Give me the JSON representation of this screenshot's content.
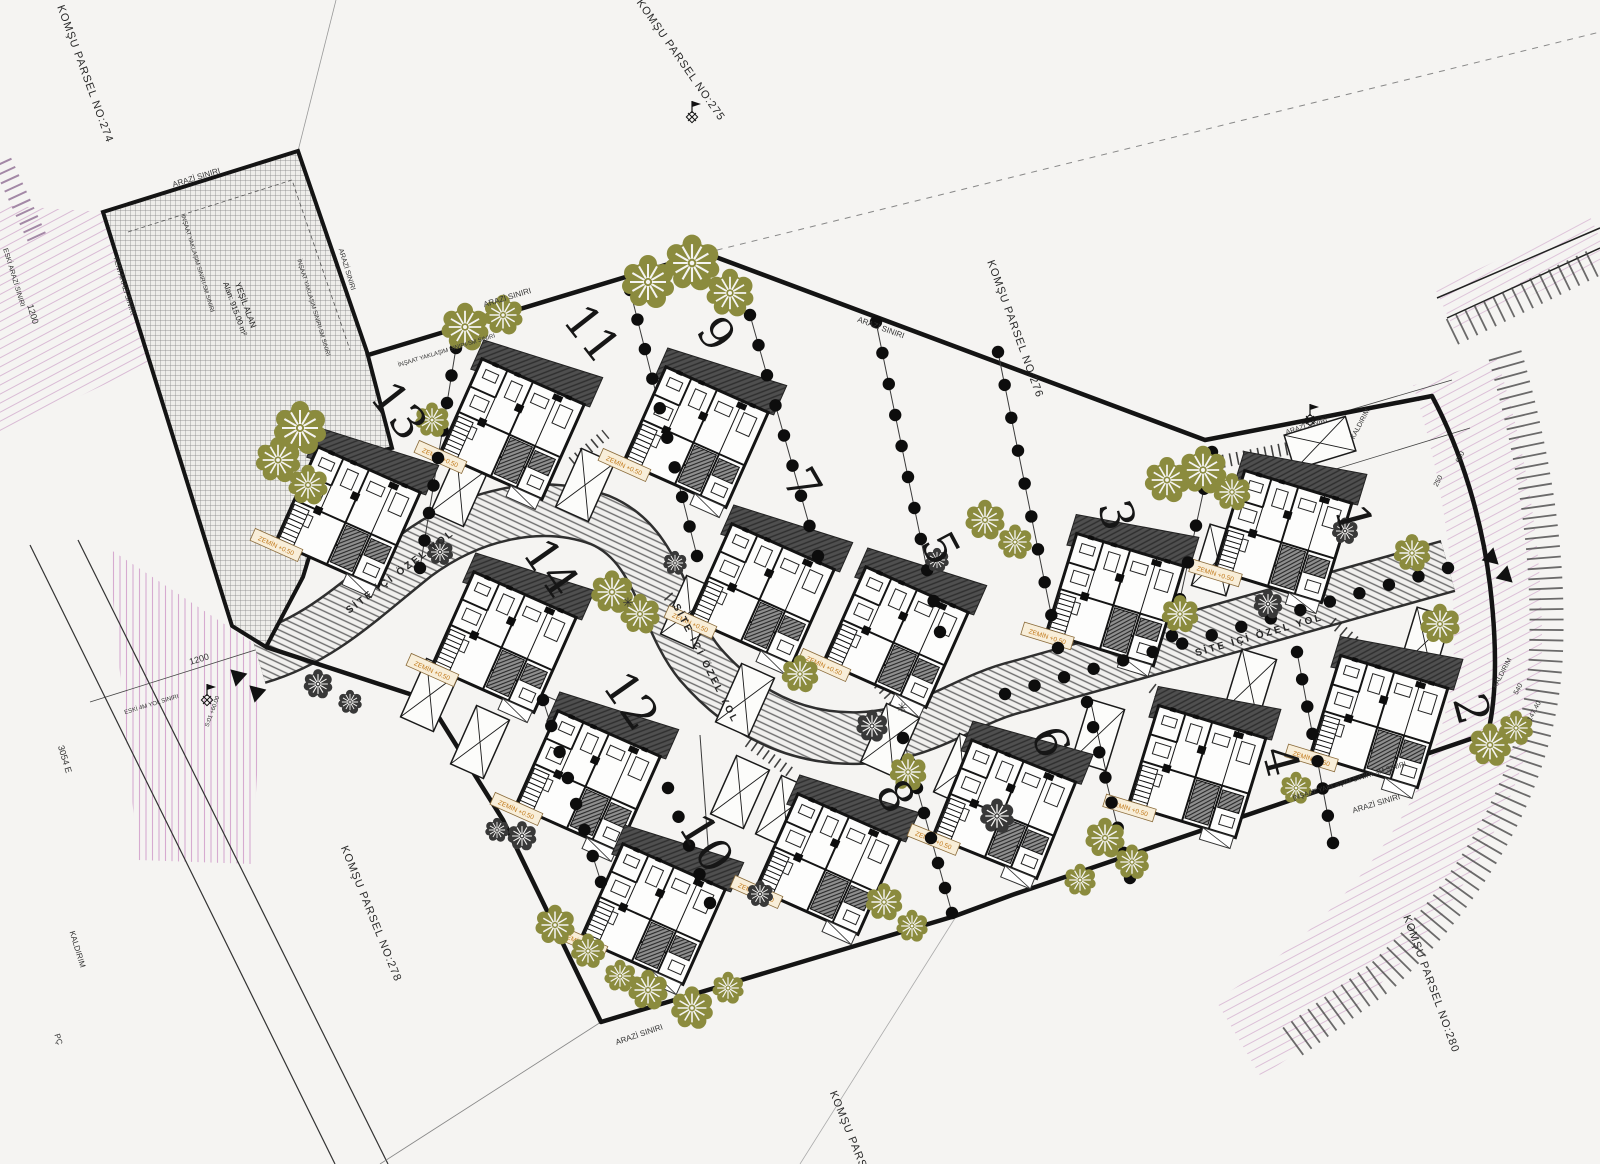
{
  "title": "Villa Sitesi Vaziyet Planı",
  "colors": {
    "background": "#f5f4f2",
    "boundary": "#141414",
    "tree_olive": "#8b8b3e",
    "tree_dark": "#383838",
    "road_line": "#2f2f2f",
    "pink": "#c583bd",
    "label_orange": "#c07818",
    "roof_dark": "#4f4f4f"
  },
  "parcel_labels": [
    {
      "text": "KOMŞU PARSEL NO:274",
      "x": 82,
      "y": 75,
      "rot": 70
    },
    {
      "text": "KOMŞU PARSEL NO:275",
      "x": 678,
      "y": 62,
      "rot": 55
    },
    {
      "text": "KOMŞU PARSEL NO:276",
      "x": 1012,
      "y": 330,
      "rot": 70
    },
    {
      "text": "KOMŞU PARSEL NO:278",
      "x": 368,
      "y": 915,
      "rot": 68
    },
    {
      "text": "KOMŞU PARSEL NO:280",
      "x": 1428,
      "y": 985,
      "rot": 70
    },
    {
      "text": "KOMŞU PARSEL",
      "x": 848,
      "y": 1138,
      "rot": 68
    }
  ],
  "road_labels": [
    {
      "text": "SİTE İÇİ ÖZEL YOL",
      "x": 402,
      "y": 574,
      "rot": -37
    },
    {
      "text": "SİTE İÇİ ÖZEL YOL",
      "x": 703,
      "y": 665,
      "rot": 63
    },
    {
      "text": "SİTE İÇİ ÖZEL YOL",
      "x": 1260,
      "y": 638,
      "rot": -16
    }
  ],
  "green_area": {
    "line1": "YEŞİL ALAN",
    "line2": "Alan: 915.00 m²",
    "x": 243,
    "y": 306,
    "rot": 70
  },
  "house_label": "ZEMİN +0.50",
  "plots": [
    {
      "number": "1",
      "x": 1350,
      "y": 520,
      "rot": 75
    },
    {
      "number": "2",
      "x": 1468,
      "y": 710,
      "rot": 75
    },
    {
      "number": "3",
      "x": 1113,
      "y": 516,
      "rot": 75
    },
    {
      "number": "4",
      "x": 1277,
      "y": 762,
      "rot": 75
    },
    {
      "number": "5",
      "x": 937,
      "y": 550,
      "rot": 62
    },
    {
      "number": "6",
      "x": 1047,
      "y": 743,
      "rot": 70
    },
    {
      "number": "7",
      "x": 799,
      "y": 486,
      "rot": 60
    },
    {
      "number": "8",
      "x": 892,
      "y": 798,
      "rot": 60
    },
    {
      "number": "9",
      "x": 713,
      "y": 336,
      "rot": 55
    },
    {
      "number": "10",
      "x": 703,
      "y": 845,
      "rot": 58
    },
    {
      "number": "11",
      "x": 589,
      "y": 336,
      "rot": 52
    },
    {
      "number": "12",
      "x": 628,
      "y": 703,
      "rot": 55
    },
    {
      "number": "13",
      "x": 396,
      "y": 413,
      "rot": 52
    },
    {
      "number": "14",
      "x": 548,
      "y": 570,
      "rot": 55
    }
  ],
  "houses": [
    {
      "plot": "13",
      "x": 352,
      "y": 508,
      "rot": 24
    },
    {
      "plot": "11",
      "x": 516,
      "y": 420,
      "rot": 24
    },
    {
      "plot": "9",
      "x": 700,
      "y": 428,
      "rot": 24
    },
    {
      "plot": "7",
      "x": 766,
      "y": 585,
      "rot": 24
    },
    {
      "plot": "5",
      "x": 900,
      "y": 628,
      "rot": 24
    },
    {
      "plot": "14",
      "x": 508,
      "y": 633,
      "rot": 24
    },
    {
      "plot": "12",
      "x": 592,
      "y": 772,
      "rot": 24
    },
    {
      "plot": "10",
      "x": 657,
      "y": 905,
      "rot": 24
    },
    {
      "plot": "8",
      "x": 832,
      "y": 855,
      "rot": 24
    },
    {
      "plot": "6",
      "x": 1008,
      "y": 800,
      "rot": 22
    },
    {
      "plot": "3",
      "x": 1118,
      "y": 590,
      "rot": 17
    },
    {
      "plot": "1",
      "x": 1286,
      "y": 527,
      "rot": 17
    },
    {
      "plot": "4",
      "x": 1200,
      "y": 762,
      "rot": 17
    },
    {
      "plot": "2",
      "x": 1382,
      "y": 712,
      "rot": 17
    }
  ],
  "trees_olive": [
    [
      300,
      428,
      1.0
    ],
    [
      278,
      460,
      0.85
    ],
    [
      308,
      485,
      0.75
    ],
    [
      465,
      327,
      0.9
    ],
    [
      503,
      315,
      0.75
    ],
    [
      648,
      282,
      1.0
    ],
    [
      692,
      263,
      1.05
    ],
    [
      730,
      293,
      0.9
    ],
    [
      432,
      420,
      0.65
    ],
    [
      612,
      592,
      0.8
    ],
    [
      640,
      614,
      0.75
    ],
    [
      800,
      674,
      0.7
    ],
    [
      908,
      772,
      0.7
    ],
    [
      985,
      520,
      0.75
    ],
    [
      1015,
      542,
      0.65
    ],
    [
      1167,
      480,
      0.85
    ],
    [
      1203,
      470,
      0.9
    ],
    [
      1232,
      492,
      0.7
    ],
    [
      1180,
      614,
      0.7
    ],
    [
      1440,
      624,
      0.75
    ],
    [
      1412,
      553,
      0.7
    ],
    [
      1490,
      745,
      0.8
    ],
    [
      1516,
      728,
      0.65
    ],
    [
      1296,
      788,
      0.6
    ],
    [
      1105,
      838,
      0.75
    ],
    [
      1132,
      862,
      0.65
    ],
    [
      1080,
      880,
      0.6
    ],
    [
      884,
      902,
      0.7
    ],
    [
      912,
      926,
      0.6
    ],
    [
      555,
      925,
      0.75
    ],
    [
      588,
      951,
      0.65
    ],
    [
      620,
      976,
      0.6
    ],
    [
      648,
      990,
      0.75
    ],
    [
      692,
      1008,
      0.8
    ],
    [
      728,
      988,
      0.6
    ]
  ],
  "trees_dark": [
    [
      872,
      726,
      0.6
    ],
    [
      997,
      816,
      0.65
    ],
    [
      1268,
      604,
      0.55
    ],
    [
      318,
      684,
      0.55
    ],
    [
      350,
      702,
      0.45
    ],
    [
      522,
      836,
      0.55
    ],
    [
      760,
      894,
      0.5
    ],
    [
      1345,
      531,
      0.5
    ],
    [
      440,
      552,
      0.5
    ],
    [
      937,
      560,
      0.45
    ],
    [
      675,
      563,
      0.45
    ],
    [
      497,
      830,
      0.45
    ]
  ],
  "carports": [
    [
      460,
      490,
      24
    ],
    [
      585,
      485,
      24
    ],
    [
      690,
      612,
      24
    ],
    [
      745,
      700,
      24
    ],
    [
      890,
      740,
      24
    ],
    [
      963,
      770,
      24
    ],
    [
      430,
      695,
      24
    ],
    [
      480,
      742,
      24
    ],
    [
      740,
      792,
      24
    ],
    [
      785,
      812,
      24
    ],
    [
      1320,
      443,
      73
    ],
    [
      1218,
      560,
      17
    ],
    [
      1098,
      735,
      17
    ],
    [
      1250,
      685,
      17
    ],
    [
      1425,
      643,
      17
    ]
  ],
  "dot_chains": [
    [
      456,
      348,
      420,
      568,
      9
    ],
    [
      630,
      290,
      697,
      556,
      10
    ],
    [
      750,
      315,
      818,
      556,
      9
    ],
    [
      876,
      322,
      940,
      632,
      11
    ],
    [
      998,
      352,
      1058,
      648,
      10
    ],
    [
      1212,
      452,
      1172,
      636,
      6
    ],
    [
      1005,
      694,
      1448,
      568,
      16
    ],
    [
      668,
      788,
      710,
      903,
      5
    ],
    [
      543,
      700,
      601,
      882,
      8
    ],
    [
      903,
      738,
      952,
      913,
      8
    ],
    [
      1087,
      702,
      1130,
      878,
      8
    ],
    [
      1297,
      652,
      1333,
      843,
      8
    ]
  ],
  "dividers": [
    [
      456,
      348,
      420,
      568
    ],
    [
      630,
      290,
      697,
      556
    ],
    [
      750,
      315,
      818,
      556
    ],
    [
      876,
      322,
      940,
      632
    ],
    [
      998,
      352,
      1058,
      648
    ],
    [
      1212,
      452,
      1172,
      636
    ],
    [
      543,
      700,
      601,
      882
    ],
    [
      903,
      738,
      952,
      913
    ],
    [
      1087,
      702,
      1130,
      878
    ],
    [
      1297,
      652,
      1333,
      843
    ],
    [
      700,
      735,
      712,
      900
    ],
    [
      440,
      650,
      560,
      702
    ]
  ],
  "ladders": [
    [
      1188,
      468,
      1322,
      442,
      13
    ],
    [
      452,
      438,
      488,
      406,
      11
    ],
    [
      572,
      462,
      606,
      434,
      11
    ],
    [
      668,
      596,
      706,
      638,
      11
    ],
    [
      878,
      684,
      908,
      716,
      11
    ],
    [
      748,
      742,
      790,
      772,
      11
    ],
    [
      1152,
      688,
      1188,
      716,
      11
    ],
    [
      1332,
      622,
      1368,
      652,
      11
    ]
  ],
  "misc_texts": [
    {
      "t": "ARAZİ SINIRI",
      "x": 197,
      "y": 180,
      "r": -17,
      "s": 8
    },
    {
      "t": "ARAZİ SINIRI",
      "x": 508,
      "y": 300,
      "r": -17,
      "s": 8
    },
    {
      "t": "ARAZİ SINIRI",
      "x": 880,
      "y": 330,
      "r": 20,
      "s": 8
    },
    {
      "t": "ARAZİ SINIRI",
      "x": 1307,
      "y": 428,
      "r": -17,
      "s": 7
    },
    {
      "t": "ARAZİ SINIRI",
      "x": 1377,
      "y": 806,
      "r": -17,
      "s": 8
    },
    {
      "t": "ARAZİ SINIRI",
      "x": 640,
      "y": 1037,
      "r": -19,
      "s": 8
    },
    {
      "t": "ARAZİ SINIRI",
      "x": 345,
      "y": 270,
      "r": 73,
      "s": 7
    },
    {
      "t": "ESKİ ARAZİ SINIRI",
      "x": 12,
      "y": 278,
      "r": 73,
      "s": 7
    },
    {
      "t": "YENİ ARAZİ SINIRI",
      "x": 122,
      "y": 286,
      "r": 73,
      "s": 7
    },
    {
      "t": "İNŞAAT YAKLAŞIM SINIRI-5M SINIRI",
      "x": 196,
      "y": 264,
      "r": 73,
      "s": 6
    },
    {
      "t": "İNŞAAT YAKLAŞIM SINIRI-5M SINIRI",
      "x": 312,
      "y": 308,
      "r": 73,
      "s": 6
    },
    {
      "t": "İNŞAAT YAKLAŞIM SINIRI-5M SINIRI",
      "x": 447,
      "y": 352,
      "r": -17,
      "s": 6
    },
    {
      "t": "İNŞAAT YAKLAŞIM SINIRI-3M SINIRI",
      "x": 1350,
      "y": 783,
      "r": -17,
      "s": 7
    },
    {
      "t": "KALDIRIM",
      "x": 1362,
      "y": 425,
      "r": -62,
      "s": 7
    },
    {
      "t": "KALDIRIM",
      "x": 1504,
      "y": 674,
      "r": -62,
      "s": 7
    },
    {
      "t": "KALDIRIM",
      "x": 75,
      "y": 950,
      "r": 73,
      "s": 8
    },
    {
      "t": "1200",
      "x": 200,
      "y": 662,
      "r": -17,
      "s": 9
    },
    {
      "t": "1200",
      "x": 30,
      "y": 315,
      "r": 73,
      "s": 9
    },
    {
      "t": "3054 E",
      "x": 62,
      "y": 760,
      "r": 73,
      "s": 9
    },
    {
      "t": "PÇ",
      "x": 56,
      "y": 1040,
      "r": 73,
      "s": 8
    },
    {
      "t": "147.40",
      "x": 1536,
      "y": 712,
      "r": -62,
      "s": 7
    },
    {
      "t": "540",
      "x": 1520,
      "y": 690,
      "r": -62,
      "s": 7
    },
    {
      "t": "650",
      "x": 1462,
      "y": 458,
      "r": -62,
      "s": 7
    },
    {
      "t": "250",
      "x": 1440,
      "y": 482,
      "r": -62,
      "s": 7
    },
    {
      "t": "ESKİ 4M YOL SINIRI",
      "x": 152,
      "y": 706,
      "r": -17,
      "s": 6
    },
    {
      "t": "S:01 +60.00",
      "x": 214,
      "y": 712,
      "r": -70,
      "s": 6
    },
    {
      "t": "✳",
      "x": 628,
      "y": 607,
      "r": 0,
      "s": 13
    },
    {
      "t": "✳",
      "x": 902,
      "y": 712,
      "r": 0,
      "s": 13
    }
  ],
  "survey_markers": [
    [
      1310,
      420
    ],
    [
      207,
      700
    ],
    [
      692,
      117
    ]
  ],
  "triangles": [
    [
      1496,
      556,
      -17
    ],
    [
      1510,
      574,
      -17
    ],
    [
      233,
      678,
      163
    ],
    [
      252,
      694,
      163
    ]
  ]
}
